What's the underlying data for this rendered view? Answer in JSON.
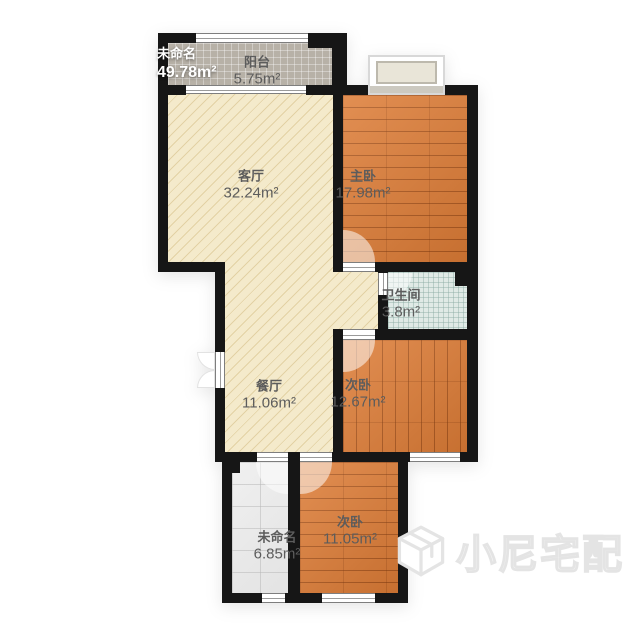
{
  "page": {
    "background": "#ffffff"
  },
  "plan": {
    "unnamed_total": {
      "name": "未命名",
      "area": "49.78m²"
    },
    "rooms": [
      {
        "id": "balcony",
        "name": "阳台",
        "area": "5.75m²"
      },
      {
        "id": "living-room",
        "name": "客厅",
        "area": "32.24m²"
      },
      {
        "id": "master-bedroom",
        "name": "主卧",
        "area": "17.98m²"
      },
      {
        "id": "bathroom",
        "name": "卫生间",
        "area": "3.8m²"
      },
      {
        "id": "dining-room",
        "name": "餐厅",
        "area": "11.06m²"
      },
      {
        "id": "second-bedroom",
        "name": "次卧",
        "area": "12.67m²"
      },
      {
        "id": "unnamed-room",
        "name": "未命名",
        "area": "6.85m²"
      },
      {
        "id": "third-bedroom",
        "name": "次卧",
        "area": "11.05m²"
      }
    ],
    "colors": {
      "wall": "#161616",
      "wood_floor": "#dd7c36",
      "living_floor": "#f4eacb",
      "balcony_floor": "#b7b1a7",
      "bath_floor": "#e0eae6",
      "tile_floor": "#ebebeb",
      "label_text": "#5c5c5c",
      "total_label_text": "#ffffff",
      "watermark": "#ececec"
    }
  },
  "watermark": {
    "brand": "小尼宅配",
    "logo": "cube-logo-icon"
  }
}
